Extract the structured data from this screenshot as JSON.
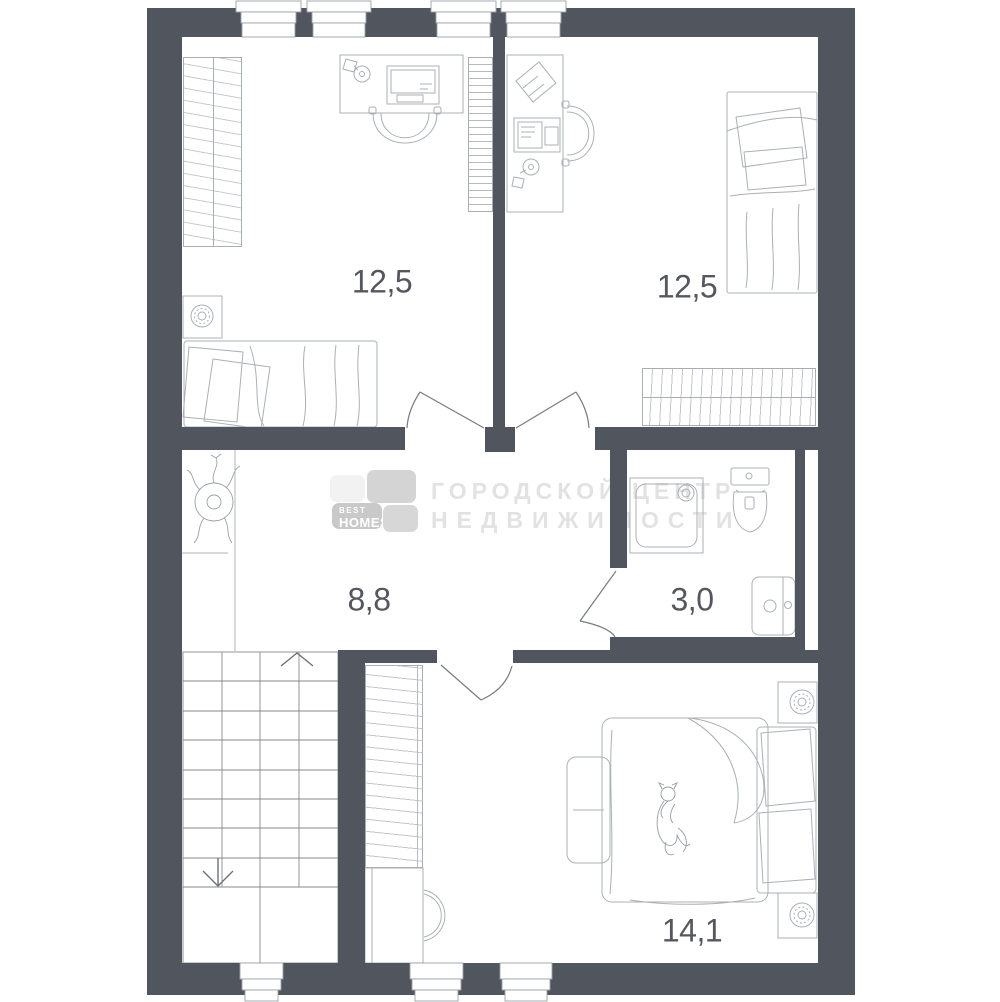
{
  "plan": {
    "title": "apartment-floor-plan",
    "rooms": [
      {
        "id": "room-top-left",
        "type": "bedroom-office",
        "area_label": "12,5"
      },
      {
        "id": "room-top-right",
        "type": "bedroom-office",
        "area_label": "12,5"
      },
      {
        "id": "hallway",
        "type": "hall-with-stairs",
        "area_label": "8,8"
      },
      {
        "id": "bathroom",
        "type": "bathroom",
        "area_label": "3,0"
      },
      {
        "id": "room-bottom",
        "type": "master-bedroom",
        "area_label": "14,1"
      }
    ]
  },
  "watermark": {
    "logo_top_text": "BEST",
    "logo_bottom_text": "HOMES",
    "company_line1": "ГОРОДСКОЙ ЦЕНТР",
    "company_line2": "НЕДВИЖИМОСТИ"
  },
  "colors": {
    "wall": "#51565e",
    "furniture_line": "#abb0b6",
    "label_text": "#54575d",
    "watermark_text": "#e2e2e2",
    "logo_tile_light": "#f2f2f2",
    "logo_tile_mid": "#d4d4d4",
    "logo_tile_dark": "#c9c9c9"
  }
}
